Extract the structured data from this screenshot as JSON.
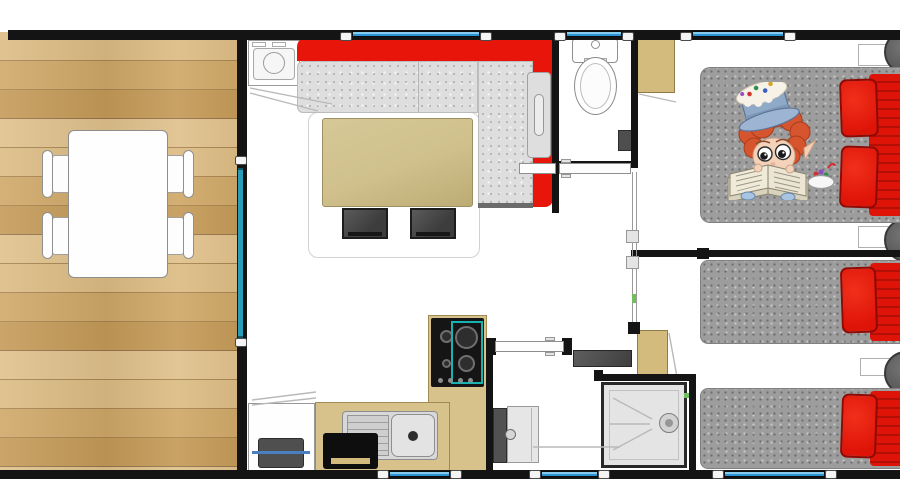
{
  "meta": {
    "image_type": "architectural floor plan, top-down view, mobile-home / holiday chalet",
    "visible_text": "none"
  },
  "colors": {
    "wall": "#141414",
    "floor_white": "#ffffff",
    "window_blue": "#2b94d4",
    "glass_teal": "#2a9cba",
    "hob_teal": "#17b2b2",
    "sofa_red": "#e8150b",
    "sofa_seat_gray": "#dedede",
    "coffee_table_tan": "#cfc08c",
    "stool_dark": "#3d3d3d",
    "counter_tan": "#d8c28c",
    "cabinet_tan": "#d3ba7d",
    "wood_light": "#dcbc84",
    "wood_mid": "#cfa868",
    "wood_deep": "#c49a58",
    "mattress_gray": "#9d9d9d",
    "bedding_red": "#df1408",
    "pouf_gray": "#575757",
    "shower_gray": "#e4e4e4",
    "appliance_dark": "#4f4f4f",
    "accent_green": "#6fbf5f",
    "steel_gray": "#d8d8d8"
  },
  "rooms": [
    {
      "id": "terrace",
      "kind": "wooden deck",
      "furniture": [
        "dining-table",
        "chair-top-left",
        "chair-bottom-left",
        "chair-top-right",
        "chair-bottom-right",
        "sliding-glass-door"
      ]
    },
    {
      "id": "living-room",
      "kind": "lounge",
      "furniture": [
        "corner-sofa (red frame, gray speckled seats, L-shape)",
        "sofa-side-table",
        "coffee-table",
        "ottoman-1",
        "ottoman-2",
        "washing-machine"
      ]
    },
    {
      "id": "kitchen",
      "kind": "kitchenette",
      "furniture": [
        "gas-hob (4 burners, teal glass lid)",
        "sink-with-drainboard",
        "oven-black",
        "white-cabinet",
        "cooler-box (blue handle)",
        "tan-counter-L"
      ]
    },
    {
      "id": "wc",
      "kind": "toilet room",
      "furniture": [
        "toilet",
        "wall-box",
        "sliding-door"
      ]
    },
    {
      "id": "bathroom",
      "kind": "shower room",
      "furniture": [
        "washbasin",
        "shower-cabin (corner, round drain)",
        "radiator-shelf",
        "storage-cabinet-tan",
        "pocket-door"
      ]
    },
    {
      "id": "bedroom-master",
      "kind": "double bedroom",
      "furniture": [
        "double-bed (gray mattress, 2 red pillows, red duvet)",
        "wardrobe-tan",
        "pouf-1",
        "pouf-2",
        "nightstands",
        "mascot-illustration"
      ]
    },
    {
      "id": "bedroom-twin",
      "kind": "twin bedroom",
      "furniture": [
        "single-bed-1",
        "single-bed-2",
        "red pillows and duvets",
        "pouf-3",
        "nightstand"
      ]
    }
  ],
  "openings": {
    "windows_top": 3,
    "windows_bottom": 3,
    "glass_door_terrace": 1,
    "interior_doors": [
      "wc-sliding-door",
      "bedroom-corridor-sliding-door",
      "bathroom-pocket-door",
      "wardrobe-swing",
      "bathroom-cabinet-swing",
      "washing-machine-door-swing"
    ]
  },
  "mascot": {
    "description": "elf child with curly red hair wearing a frosted cupcake top-hat with candy sprinkles, reading a large open book, blue shoes, bowl of sweets beside"
  }
}
